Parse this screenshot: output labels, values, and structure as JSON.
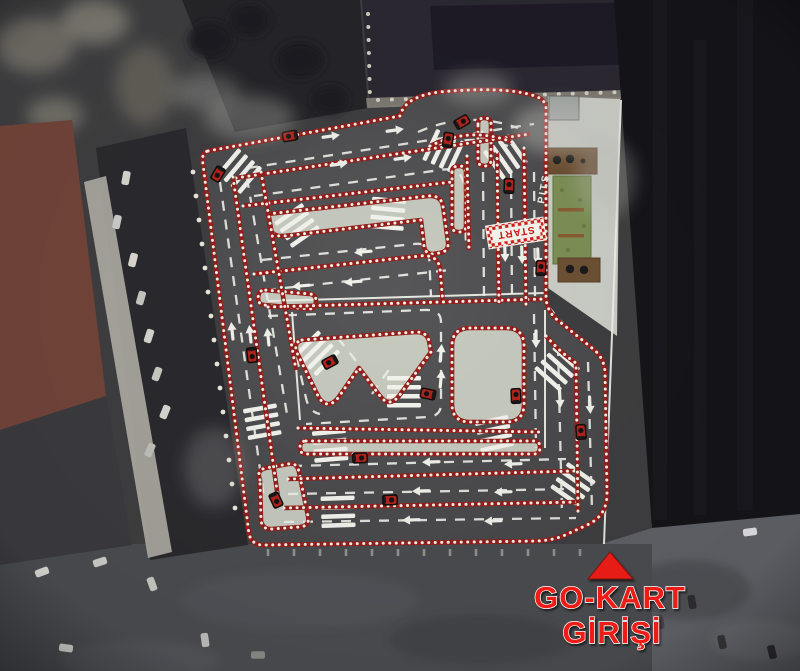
{
  "entrance_sign": {
    "line1": "GO-KART",
    "line2": "GİRİŞİ",
    "text_color": "#ee1c16",
    "arrow_color": "#e81d17"
  },
  "track_labels": {
    "start": "START",
    "pits": "PITS"
  },
  "palette": {
    "asphalt": "#4d4d4f",
    "infield": "#c6cabf",
    "barrier_red": "#96201c",
    "barrier_white": "#f3f3ee",
    "grass": "#7d9055",
    "deck_brown": "#6e5134",
    "apron_concrete": "#cbcec6"
  },
  "track": {
    "karts": [
      [
        290,
        136,
        -10
      ],
      [
        218,
        174,
        -60
      ],
      [
        448,
        140,
        100
      ],
      [
        509,
        186,
        92
      ],
      [
        541,
        268,
        93
      ],
      [
        330,
        362,
        -28
      ],
      [
        428,
        394,
        12
      ],
      [
        516,
        396,
        88
      ],
      [
        360,
        458,
        177
      ],
      [
        390,
        500,
        178
      ],
      [
        276,
        500,
        -115
      ],
      [
        581,
        432,
        86
      ],
      [
        252,
        355,
        -96
      ],
      [
        462,
        122,
        150
      ]
    ],
    "direction_arrows": [
      [
        332,
        136,
        -8
      ],
      [
        340,
        164,
        -8
      ],
      [
        396,
        130,
        -8
      ],
      [
        404,
        158,
        -8
      ],
      [
        362,
        252,
        175
      ],
      [
        352,
        282,
        175
      ],
      [
        300,
        286,
        175
      ],
      [
        232,
        330,
        -96
      ],
      [
        250,
        333,
        -96
      ],
      [
        268,
        336,
        -96
      ],
      [
        505,
        254,
        88
      ],
      [
        522,
        256,
        88
      ],
      [
        538,
        258,
        88
      ],
      [
        441,
        352,
        -85
      ],
      [
        441,
        378,
        -85
      ],
      [
        560,
        400,
        87
      ],
      [
        590,
        406,
        87
      ],
      [
        536,
        340,
        90
      ],
      [
        430,
        462,
        178
      ],
      [
        420,
        491,
        178
      ],
      [
        410,
        520,
        178
      ],
      [
        512,
        464,
        178
      ],
      [
        502,
        492,
        178
      ],
      [
        492,
        521,
        178
      ]
    ],
    "corner_stripes": [
      [
        238,
        170,
        40
      ],
      [
        296,
        224,
        55
      ],
      [
        388,
        212,
        95
      ],
      [
        442,
        150,
        25
      ],
      [
        504,
        158,
        -35
      ],
      [
        316,
        352,
        45
      ],
      [
        404,
        390,
        90
      ],
      [
        556,
        370,
        -48
      ],
      [
        330,
        444,
        85
      ],
      [
        338,
        510,
        88
      ],
      [
        494,
        432,
        78
      ],
      [
        572,
        486,
        -55
      ],
      [
        262,
        420,
        80
      ]
    ],
    "pit_bays": [
      [
        489,
        198
      ],
      [
        506,
        196
      ],
      [
        523,
        194
      ],
      [
        489,
        216
      ],
      [
        506,
        214
      ],
      [
        523,
        212
      ],
      [
        523,
        252
      ],
      [
        523,
        270
      ],
      [
        489,
        288
      ],
      [
        506,
        286
      ],
      [
        541,
        188
      ],
      [
        541,
        206
      ],
      [
        541,
        224
      ],
      [
        541,
        242
      ],
      [
        541,
        260
      ],
      [
        541,
        278
      ],
      [
        541,
        296
      ],
      [
        541,
        314
      ]
    ],
    "edge_posts_left": [
      [
        193,
        172
      ],
      [
        196,
        196
      ],
      [
        199,
        220
      ],
      [
        202,
        244
      ],
      [
        205,
        268
      ],
      [
        208,
        292
      ],
      [
        211,
        316
      ],
      [
        214,
        340
      ],
      [
        217,
        364
      ],
      [
        220,
        388
      ],
      [
        223,
        412
      ],
      [
        226,
        436
      ],
      [
        229,
        460
      ],
      [
        232,
        484
      ],
      [
        235,
        508
      ]
    ],
    "edge_posts_bottom": {
      "y": 549,
      "x_start": 268,
      "x_end": 594,
      "step": 26
    }
  },
  "background": {
    "cars_left": [
      [
        126,
        178,
        -80,
        "#d9d9d4"
      ],
      [
        117,
        222,
        -78,
        "#cfcfca"
      ],
      [
        133,
        260,
        -76,
        "#dedad2"
      ],
      [
        141,
        298,
        -74,
        "#c9c9c4"
      ],
      [
        149,
        336,
        -72,
        "#d6d6d0"
      ],
      [
        157,
        374,
        -70,
        "#ccccc6"
      ],
      [
        165,
        412,
        -68,
        "#d9d9d4"
      ],
      [
        150,
        450,
        -66,
        "#c2c2bc"
      ]
    ],
    "cars_bottom": [
      [
        42,
        572,
        -20,
        "#d8d8d4"
      ],
      [
        100,
        562,
        -18,
        "#cfcfcb"
      ],
      [
        152,
        584,
        70,
        "#c8c8c4"
      ],
      [
        66,
        648,
        8,
        "#d8d8d4"
      ],
      [
        205,
        640,
        82,
        "#bfbfbb"
      ],
      [
        258,
        655,
        0,
        "#8a8a86"
      ]
    ],
    "cars_right": [
      [
        750,
        532,
        -8,
        "#e2e2e4"
      ],
      [
        692,
        602,
        80,
        "#2e2e32"
      ],
      [
        722,
        642,
        78,
        "#3a3a3e"
      ],
      [
        772,
        652,
        76,
        "#2e2e32"
      ],
      [
        660,
        622,
        82,
        "#46464a"
      ]
    ]
  }
}
